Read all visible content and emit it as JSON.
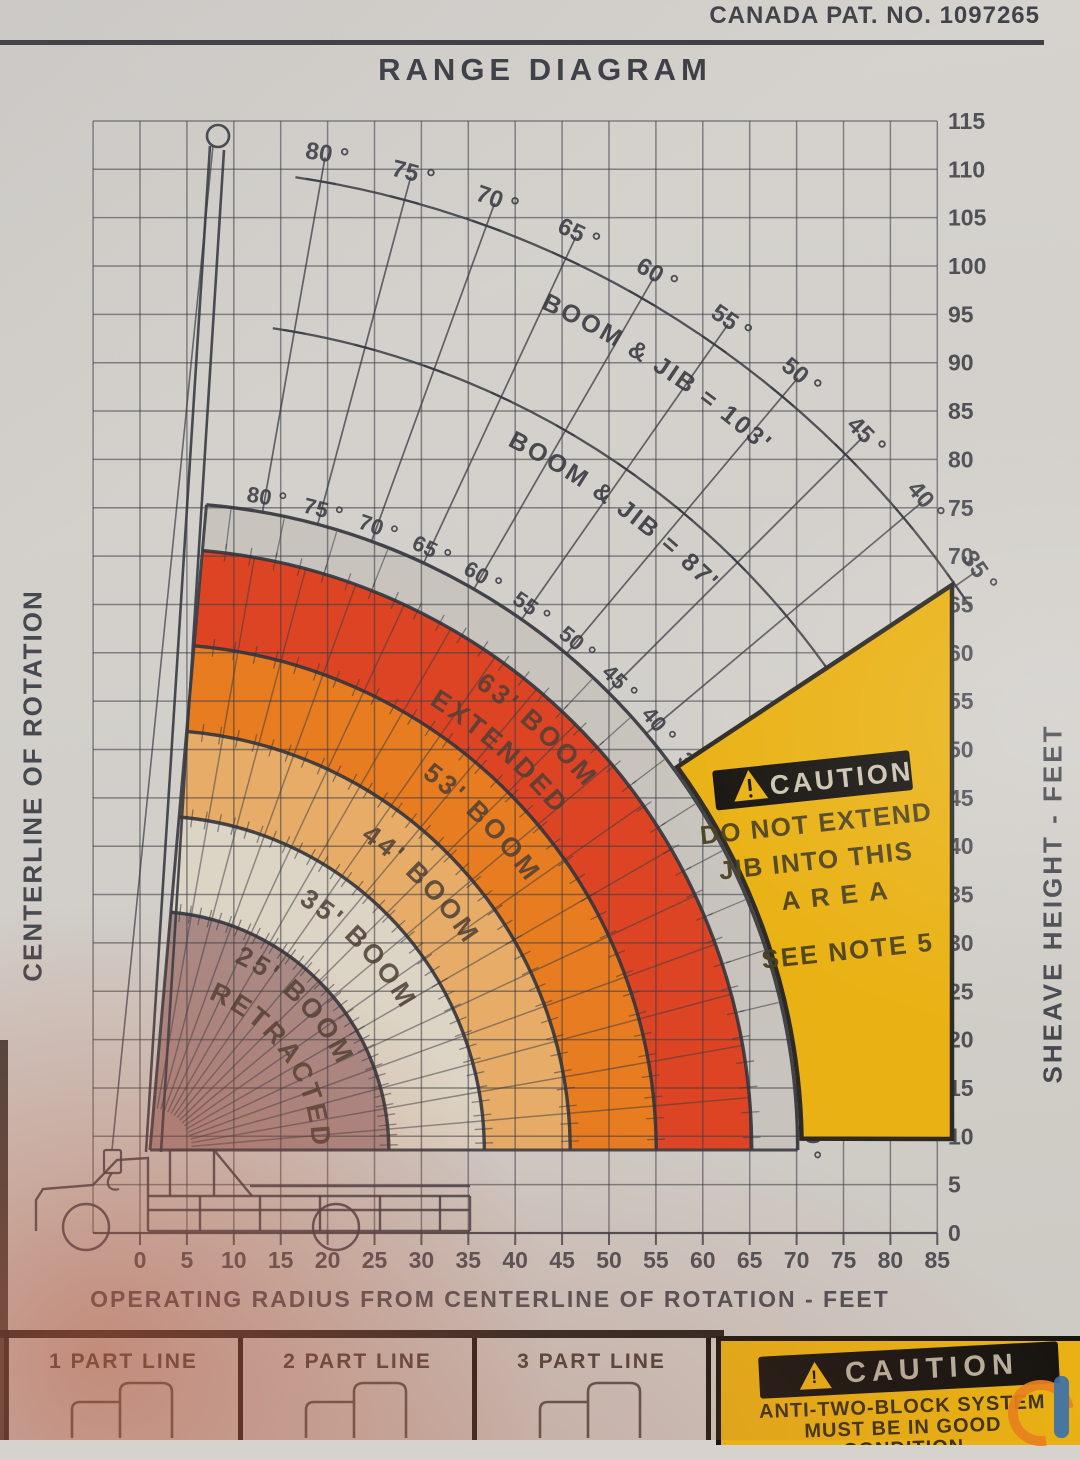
{
  "header": {
    "patent": "CANADA PAT. NO. 1097265",
    "title": "RANGE DIAGRAM"
  },
  "axes": {
    "left_label": "CENTERLINE OF ROTATION",
    "right_label": "SHEAVE HEIGHT - FEET",
    "bottom_label": "OPERATING RADIUS FROM CENTERLINE OF ROTATION - FEET",
    "sheave_ticks": [
      115,
      110,
      105,
      100,
      95,
      90,
      85,
      80,
      75,
      70,
      65,
      60,
      55,
      50,
      45,
      40,
      35,
      30,
      25,
      20,
      15,
      10,
      5,
      0
    ],
    "radius_ticks": [
      0,
      5,
      10,
      15,
      20,
      25,
      30,
      35,
      40,
      45,
      50,
      55,
      60,
      65,
      70,
      75,
      80,
      85
    ]
  },
  "chart_data": {
    "type": "area",
    "title": "RANGE DIAGRAM",
    "xlabel": "OPERATING RADIUS FROM CENTERLINE OF ROTATION - FEET",
    "ylabel": "SHEAVE HEIGHT - FEET",
    "xlim": [
      0,
      85
    ],
    "ylim": [
      0,
      115
    ],
    "grid": true,
    "angle_unit": "°",
    "boom_angle_scale_deg": [
      80,
      75,
      70,
      65,
      60,
      55,
      50,
      45,
      40,
      35,
      30,
      25,
      20,
      15,
      10,
      5,
      0
    ],
    "jib_angle_labels_deg": [
      80,
      75,
      70,
      65,
      60,
      55,
      50,
      45,
      40,
      35
    ],
    "bands": [
      {
        "name": "25' BOOM RETRACTED",
        "label_lines": [
          "25' BOOM",
          "RETRACTED"
        ],
        "boom_ft": 25,
        "color": "#aa8a86"
      },
      {
        "name": "35' BOOM",
        "label_lines": [
          "35' BOOM"
        ],
        "boom_ft": 35,
        "color": "#dcd4c4"
      },
      {
        "name": "44' BOOM",
        "label_lines": [
          "44' BOOM"
        ],
        "boom_ft": 44,
        "color": "#e7ad68"
      },
      {
        "name": "53' BOOM",
        "label_lines": [
          "53' BOOM"
        ],
        "boom_ft": 53,
        "color": "#e87c20"
      },
      {
        "name": "63' BOOM EXTENDED",
        "label_lines": [
          "63' BOOM",
          "EXTENDED"
        ],
        "boom_ft": 63,
        "color": "#dd4424"
      }
    ],
    "jib_arcs": [
      {
        "label": "BOOM & JIB = 103'",
        "boom_jib_ft": 103
      },
      {
        "label": "BOOM & JIB = 87'",
        "boom_jib_ft": 87
      }
    ],
    "colors": {
      "background": "#d2cfca",
      "ink": "#3a3b43",
      "scale_band": "#c8c4bd",
      "caution_yellow": "#e9b113",
      "caution_black": "#171410"
    }
  },
  "caution_jib": {
    "banner": "CAUTION",
    "lines": [
      "DO NOT EXTEND",
      "JIB INTO THIS",
      "AREA",
      "SEE NOTE 5"
    ]
  },
  "footer": {
    "part_lines": [
      {
        "label": "1 PART LINE"
      },
      {
        "label": "2 PART LINE"
      },
      {
        "label": "3 PART LINE"
      }
    ],
    "atb": {
      "banner": "CAUTION",
      "lines": [
        "ANTI-TWO-BLOCK SYSTEM",
        "MUST BE IN GOOD",
        "CONDITION"
      ]
    }
  }
}
